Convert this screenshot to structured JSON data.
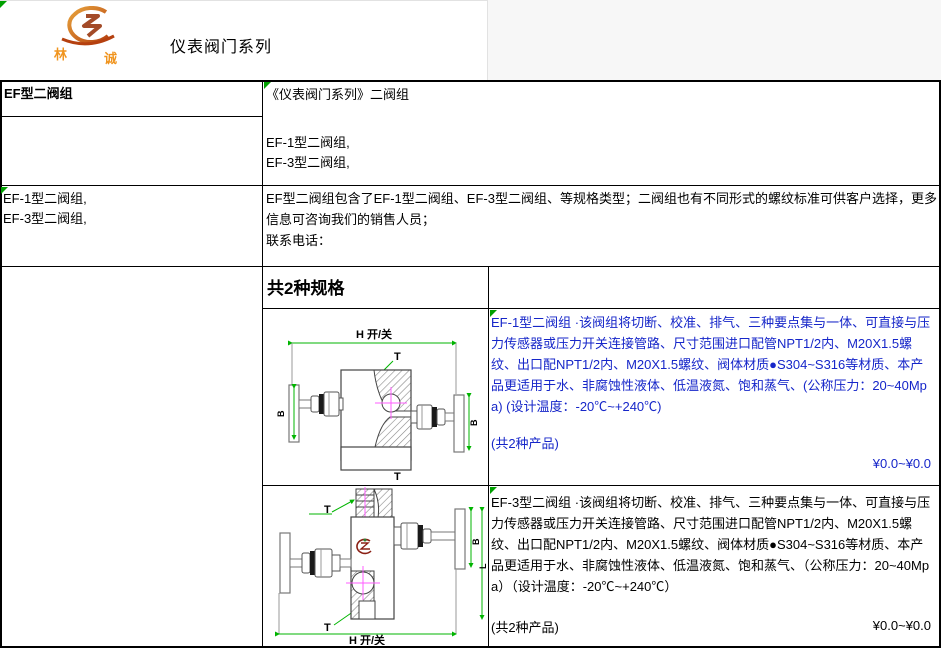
{
  "header": {
    "brand": {
      "char_left": "林",
      "char_right": "诚"
    },
    "title": "仪表阀门系列"
  },
  "table": {
    "row1": {
      "left_title": "EF型二阀组",
      "right": {
        "series_title": "《仪表阀门系列》二阀组",
        "model_line1": "EF-1型二阀组,",
        "model_line2": "EF-3型二阀组,"
      }
    },
    "row2": {
      "left_line1": "EF-1型二阀组,",
      "left_line2": "EF-3型二阀组,",
      "right_description": "EF型二阀组包含了EF-1型二阀组、EF-3型二阀组、等规格类型；二阀组也有不同形式的螺纹标准可供客户选择，更多信息可咨询我们的销售人员；",
      "contact_label": "联系电话："
    },
    "spec_header": "共2种规格",
    "products": [
      {
        "description": "EF-1型二阀组 ·该阀组将切断、校准、排气、三种要点集与一体、可直接与压力传感器或压力开关连接管路、尺寸范围进口配管NPT1/2内、M20X1.5螺纹、出口配NPT1/2内、M20X1.5螺纹、阀体材质●S304~S316等材质、本产品更适用于水、非腐蚀性液体、低温液氮、饱和蒸气、(公称压力：20~40Mpa) (设计温度：-20℃~+240℃)",
        "count_note": "(共2种产品)",
        "price": "¥0.0~¥0.0"
      },
      {
        "description": "EF-3型二阀组  ·该阀组将切断、校准、排气、三种要点集与一体、可直接与压力传感器或压力开关连接管路、尺寸范围进口配管NPT1/2内、M20X1.5螺纹、出口配NPT1/2内、M20X1.5螺纹、阀体材质●S304~S316等材质、本产品更适用于水、非腐蚀性液体、低温液氮、饱和蒸气、（公称压力：20~40Mpa）（设计温度：-20℃~+240℃）",
        "count_note": "(共2种产品)",
        "price": "¥0.0~¥0.0"
      }
    ],
    "diagram_labels": {
      "dim_h": "H 开/关",
      "t": "T",
      "b": "B",
      "l": "L"
    }
  },
  "colors": {
    "link_blue": "#1626C9",
    "dimension_green": "#00B400",
    "brand_orange": "#F0941E",
    "logo_red": "#8B2015",
    "centerline_magenta": "#FF5CFF",
    "marker_green": "#00A000"
  }
}
